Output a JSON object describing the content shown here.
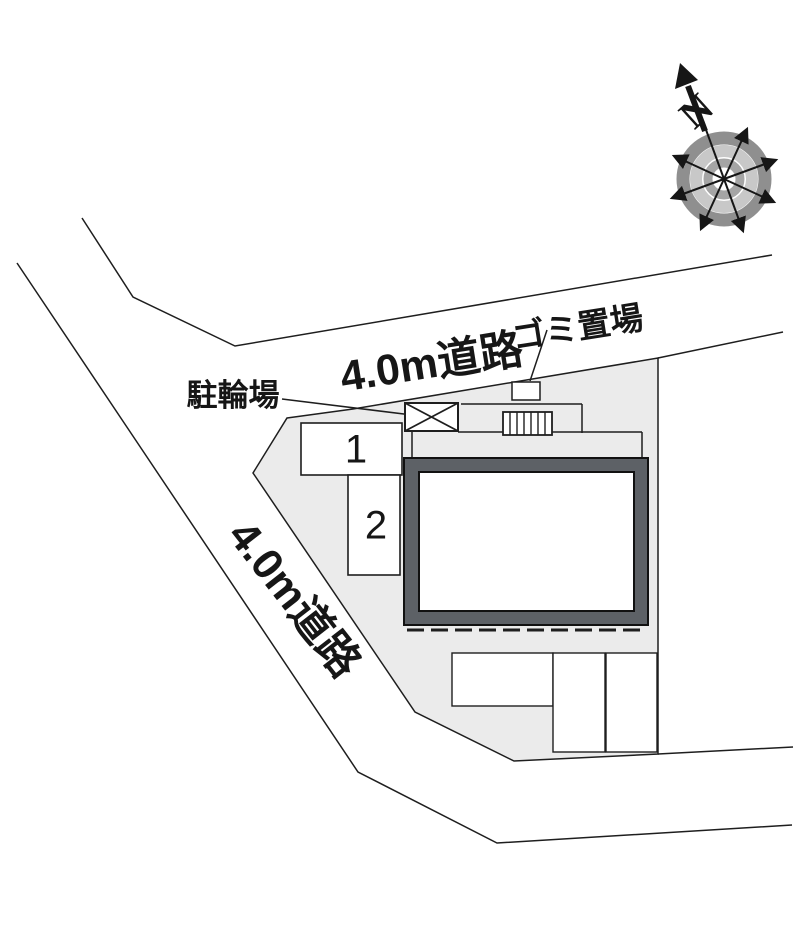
{
  "plan": {
    "roads": {
      "top_label": "4.0m道路",
      "left_label": "4.0m道路"
    },
    "facilities": {
      "garbage_label": "ゴミ置場",
      "bicycle_label": "駐輪場"
    },
    "parking_spaces": [
      {
        "label": "1"
      },
      {
        "label": "2"
      }
    ],
    "compass": {
      "north_label": "N"
    },
    "colors": {
      "background": "#ffffff",
      "site_fill": "#ebebeb",
      "building_wall": "#5d6166",
      "line": "#1e1e1e",
      "compass_ring_outer": "#8f8f8f",
      "compass_ring_mid": "#c8c8c8",
      "compass_ring_inner": "#a5a5a5"
    }
  }
}
